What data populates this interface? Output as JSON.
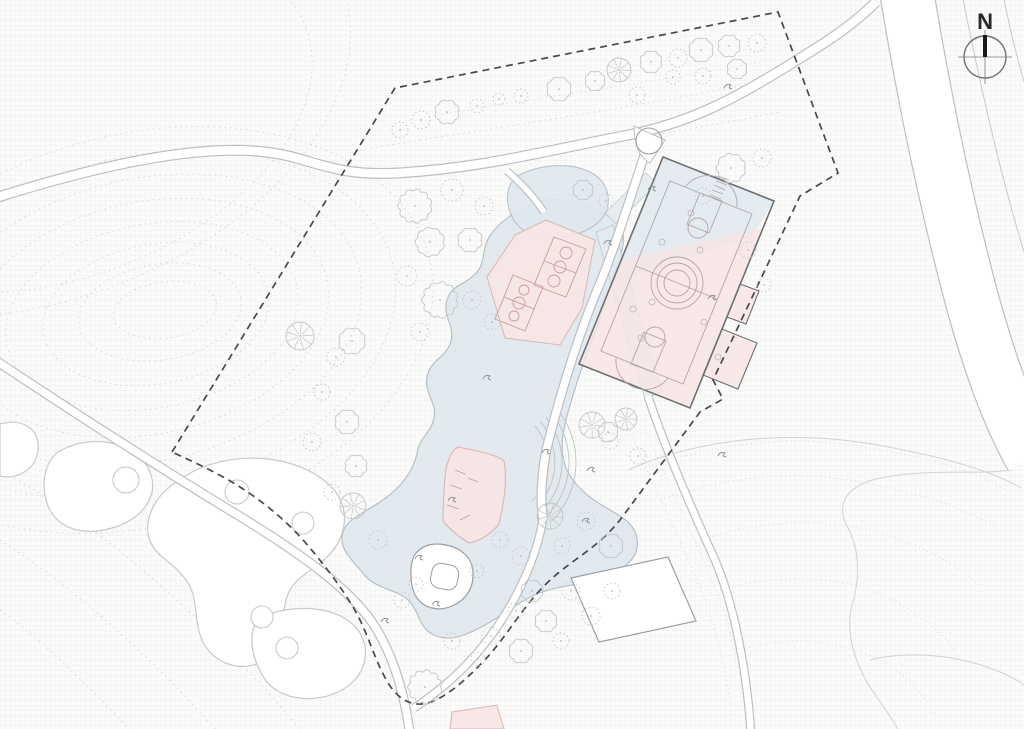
{
  "meta": {
    "title": "Landscape site plan"
  },
  "compass": {
    "label": "N"
  },
  "colors": {
    "contour": "#d4d7d9",
    "stipple": "#d9dcde",
    "meadow": "#cfd3d4",
    "blobEdge": "#c6c9cb",
    "blobFill": "#ffffff",
    "water": "#dfe8ee",
    "waterEdge": "#a9b4bb",
    "street": "#e3ebf0",
    "pink": "#f7e5e4",
    "pinkEdge": "#dcb5b3",
    "courtLinePink": "#c79d9d",
    "courtLineHall": "#b2a4a8",
    "roadCasing": "#bcbfc1",
    "roadFill": "#ffffff",
    "roadThin": "#c6c9cb",
    "hallEdge": "#6d7072",
    "hallBlue": "#dfe8ee",
    "bldgEdge": "#9ba0a3",
    "boundary": "#48494b",
    "tree": "#c2c6c8",
    "treeDot": "#b4b8ba",
    "glyph": "#85898c",
    "amphi": "#b9bec1"
  },
  "contours": {
    "ellipses": [
      [
        140,
        330,
        298,
        196,
        -14
      ],
      [
        142,
        325,
        258,
        168,
        -14
      ],
      [
        145,
        320,
        220,
        141,
        -13
      ],
      [
        148,
        318,
        183,
        116,
        -12
      ],
      [
        152,
        316,
        148,
        92,
        -11
      ],
      [
        156,
        314,
        114,
        70,
        -10
      ],
      [
        160,
        312,
        82,
        48,
        -9
      ],
      [
        165,
        310,
        52,
        28,
        -8
      ],
      [
        60,
        118,
        262,
        160,
        -20
      ],
      [
        40,
        98,
        322,
        202,
        -20
      ]
    ],
    "paths": [
      "M0,470 C90,520 190,600 300,729",
      "M0,540 C70,585 150,655 215,729",
      "M0,610 C50,645 100,700 130,729",
      "M360,150 C480,130 620,110 770,80",
      "M380,175 C500,158 640,140 780,112"
    ]
  },
  "stipple_paths": [
    "M640,470 C720,440 800,435 870,448 C930,458 975,470 1015,495",
    "M660,500 C730,475 800,470 860,482 C915,492 960,505 1000,530",
    "M700,540 C760,520 820,518 870,530 C910,540 950,560 980,585",
    "M720,590 C770,575 830,575 870,590 C905,603 935,625 955,650",
    "M740,650 C790,635 840,640 880,660 C905,673 925,695 935,715",
    "M630,430 C655,490 685,550 705,600 C718,635 728,680 732,715",
    "M643,425 C668,485 698,545 718,595 C731,630 741,676 745,712",
    "M420,118 C520,100 640,85 760,62"
  ],
  "meadow_lines": [
    "M628,470 C700,438 790,430 872,444 C935,455 985,468 1022,488",
    "M1012,470 C980,475 930,468 880,478 C845,486 835,505 848,528 C860,550 860,580 852,605 C846,628 852,660 872,690 C884,708 895,722 900,734",
    "M870,660 C910,650 960,655 1000,672 C1020,680 1032,690 1038,700"
  ],
  "context_blobs": {
    "paths": [
      "M0,424 C22,418 40,428 38,450 C36,470 16,480 0,476 Z",
      "M58,452 C92,432 138,442 150,472 C160,498 140,520 112,528 C85,536 58,530 48,506 C40,484 45,462 58,452 Z",
      "M196,470 C240,450 295,456 326,482 C352,504 348,534 330,554 C316,570 297,574 288,594 C280,614 286,640 270,656 C250,674 218,668 204,644 C192,622 200,598 186,580 C172,560 152,556 148,534 C145,512 160,492 178,481 C184,477 190,473 196,470 Z",
      "M258,618 C295,602 340,606 358,630 C372,650 366,676 342,690 C315,705 278,700 264,678 C252,658 247,636 258,618 Z"
    ],
    "circles": [
      [
        126,
        480,
        13
      ],
      [
        237,
        492,
        12
      ],
      [
        303,
        523,
        11
      ],
      [
        262,
        617,
        11
      ],
      [
        287,
        648,
        11
      ]
    ]
  },
  "water": {
    "pond": "M543,200 C523,207 503,218 492,233 C480,248 487,260 477,272 C466,285 452,284 447,300 C442,316 455,325 451,341 C447,357 430,360 427,377 C424,394 437,401 434,418 C431,434 418,438 417,454 C412,475 398,490 380,502 C360,515 345,520 342,535 C340,550 352,560 362,572 C375,590 395,588 408,600 C420,612 418,626 432,634 C450,644 468,634 485,625 C505,614 520,600 542,592 C565,584 585,585 605,577 C628,568 640,555 637,538 C634,521 616,514 600,504 C585,495 572,482 566,468 C560,452 562,436 566,420 C572,396 584,360 596,330 C606,300 616,270 622,250 C626,235 622,222 608,215 C590,206 565,197 543,200 Z",
    "plaza": "M517,176 C540,164 570,162 590,172 C606,180 612,196 606,212 C598,228 578,236 556,238 C534,240 516,230 510,212 C505,198 507,185 517,176 Z",
    "streets": [
      "596,232 613,225 662,392 645,399",
      "605,213 646,173 657,184 616,224"
    ]
  },
  "amphitheater": {
    "cx": 492,
    "cy": 462,
    "radii": [
      56,
      63,
      70,
      77,
      84
    ],
    "a1": -40,
    "a2": 45
  },
  "pink": {
    "pentagon": "546,220 595,240 582,308 560,345 505,338 487,277 515,235",
    "courts": [
      {
        "poly": "554,237 586,249 566,297 534,285",
        "line": [
          544,
          261,
          576,
          273
        ],
        "circles": [
          [
            560,
            267,
            6
          ],
          [
            566,
            253,
            6
          ],
          [
            554,
            281,
            6
          ]
        ]
      },
      {
        "poly": "513,275 543,287 525,331 495,319",
        "line": [
          504,
          297,
          534,
          309
        ],
        "circles": [
          [
            519,
            303,
            6
          ],
          [
            524,
            290,
            5
          ],
          [
            514,
            316,
            5
          ]
        ]
      }
    ],
    "pavilion": "M458,447 C478,451 498,455 504,461 C508,482 503,506 499,524 C490,535 480,541 469,543 C458,536 449,529 443,521 C443,503 444,486 446,468 C449,458 452,450 458,447 Z",
    "pavilion_marks": [
      [
        455,
        470,
        465,
        474
      ],
      [
        450,
        485,
        462,
        489
      ],
      [
        447,
        505,
        459,
        509
      ],
      [
        460,
        520,
        470,
        515
      ],
      [
        468,
        478,
        478,
        482
      ]
    ],
    "south_fragment": "452,712 497,705 504,729 450,729"
  },
  "roads": [
    {
      "d": "M-5,198 C90,168 185,146 255,151 C312,155 325,177 398,173 C482,168 545,151 628,135 C695,122 745,93 802,57 C833,38 856,22 876,2",
      "w": 11
    },
    {
      "d": "M-5,360 C70,410 160,468 236,514 C302,554 348,588 372,622 C392,652 404,690 410,734",
      "w": 10
    },
    {
      "d": "M650,138 C636,180 619,236 601,281 C581,327 561,391 547,447 C542,472 540,498 543,519",
      "w": 10
    },
    {
      "d": "M543,519 C535,566 510,614 478,652 C455,679 432,696 414,708",
      "w": 9
    },
    {
      "d": "M648,396 C662,440 690,505 715,560 C733,602 747,668 751,734",
      "w": 9
    },
    {
      "d": "M907,-6 C922,85 944,195 972,300 C990,365 1008,415 1032,458",
      "w": 55
    },
    {
      "d": "M507,171 C521,183 534,197 544,212",
      "w": 8
    }
  ],
  "road_extra_lines": [
    "M962,-6 C979,80 999,170 1024,252",
    "M1003,-6 C1010,30 1018,62 1026,88"
  ],
  "island": {
    "path": "M634,126 L665,140 L650,163 C640,158 634,145 634,126 Z",
    "tree": [
      649,
      141,
      13
    ]
  },
  "buildings": {
    "rect_sw": "571,578 668,557 696,621 599,642",
    "pavilion_outer": "M414,556 C420,546 432,542 446,545 C462,548 472,558 473,572 C474,588 466,600 452,606 C438,612 424,608 417,598 C410,588 409,567 414,556 Z",
    "pavilion_inner": {
      "x": 431,
      "y": 564,
      "w": 27,
      "h": 25,
      "rx": 9,
      "rot": 12,
      "cx": 444,
      "cy": 577
    }
  },
  "hall": {
    "outline": "663,157 774,201 690,408 579,364",
    "blue": "663,157 774,201 752,237 612,283",
    "pinkpart": "621,260 763,228 690,408 579,364",
    "bumps": [
      "722,329 757,343 738,389 703,375",
      "740,284 759,291 746,324 727,317"
    ],
    "court": {
      "poly": "670,181 752,214 683,384 601,351",
      "keys": [
        "700,193 722,201 709,233 687,224",
        "631,364 653,372 666,341 644,332"
      ],
      "lines": [
        [
          636,
          266,
          717,
          299
        ]
      ],
      "circles": [
        [
          677,
          283,
          13
        ],
        [
          677,
          283,
          20
        ],
        [
          677,
          283,
          26
        ],
        [
          698,
          228,
          10
        ],
        [
          655,
          337,
          10
        ]
      ],
      "arcs": [
        "M685,187 A29,29 0 0 1 737,207",
        "M616,358 A29,29 0 0 0 668,378"
      ],
      "scatter": [
        [
          700,
          250
        ],
        [
          652,
          302
        ],
        [
          718,
          357
        ],
        [
          641,
          338
        ],
        [
          691,
          213
        ],
        [
          662,
          242
        ],
        [
          704,
          322
        ],
        [
          633,
          309
        ]
      ],
      "ladder": [
        [
          718,
          176,
          729,
          180
        ],
        [
          716,
          181,
          727,
          185
        ],
        [
          714,
          185,
          725,
          190
        ],
        [
          712,
          190,
          723,
          194
        ],
        [
          710,
          195,
          721,
          199
        ]
      ]
    }
  },
  "boundary": "M172,452 L395,88 L778,12 L838,173 L800,196 L713,380 L723,399 L700,412 L620,520 C596,550 570,560 545,585 C520,610 505,640 480,665 C462,683 445,698 428,703 C412,707 400,700 390,686 C376,664 372,645 360,620 C348,596 330,572 310,548 C285,518 255,495 225,478 C205,467 185,458 172,452 Z",
  "trees": [
    [
      415,
      206,
      15,
      "s"
    ],
    [
      452,
      190,
      11,
      "d"
    ],
    [
      484,
      206,
      9,
      "d"
    ],
    [
      430,
      242,
      13,
      "s"
    ],
    [
      470,
      240,
      11,
      "s"
    ],
    [
      407,
      276,
      10,
      "d"
    ],
    [
      440,
      300,
      16,
      "s"
    ],
    [
      472,
      300,
      9,
      "d"
    ],
    [
      492,
      322,
      8,
      "d"
    ],
    [
      420,
      332,
      9,
      "d"
    ],
    [
      352,
      341,
      12,
      "s"
    ],
    [
      300,
      336,
      14,
      "p"
    ],
    [
      336,
      357,
      9,
      "d"
    ],
    [
      322,
      392,
      8,
      "d"
    ],
    [
      347,
      422,
      11,
      "s"
    ],
    [
      312,
      442,
      9,
      "d"
    ],
    [
      356,
      466,
      10,
      "s"
    ],
    [
      332,
      492,
      8,
      "d"
    ],
    [
      353,
      506,
      13,
      "p"
    ],
    [
      378,
      540,
      9,
      "d"
    ],
    [
      400,
      130,
      8,
      "d"
    ],
    [
      421,
      120,
      9,
      "d"
    ],
    [
      447,
      112,
      11,
      "s"
    ],
    [
      477,
      106,
      7,
      "d"
    ],
    [
      499,
      99,
      6,
      "d"
    ],
    [
      521,
      96,
      7,
      "d"
    ],
    [
      559,
      89,
      11,
      "s"
    ],
    [
      595,
      81,
      9,
      "s"
    ],
    [
      619,
      70,
      12,
      "p"
    ],
    [
      651,
      62,
      10,
      "s"
    ],
    [
      678,
      58,
      9,
      "d"
    ],
    [
      701,
      50,
      11,
      "s"
    ],
    [
      729,
      46,
      10,
      "s"
    ],
    [
      757,
      43,
      9,
      "d"
    ],
    [
      637,
      95,
      8,
      "d"
    ],
    [
      673,
      77,
      7,
      "d"
    ],
    [
      703,
      76,
      8,
      "d"
    ],
    [
      737,
      69,
      9,
      "s"
    ],
    [
      583,
      190,
      9,
      "s"
    ],
    [
      606,
      201,
      7,
      "d"
    ],
    [
      731,
      168,
      13,
      "s"
    ],
    [
      762,
      158,
      9,
      "d"
    ],
    [
      703,
      196,
      8,
      "d"
    ],
    [
      748,
      250,
      8,
      "d"
    ],
    [
      764,
      285,
      7,
      "d"
    ],
    [
      626,
      419,
      11,
      "p"
    ],
    [
      610,
      441,
      8,
      "d"
    ],
    [
      608,
      432,
      9,
      "s"
    ],
    [
      638,
      456,
      8,
      "d"
    ],
    [
      592,
      425,
      13,
      "p"
    ],
    [
      550,
      516,
      13,
      "p"
    ],
    [
      500,
      540,
      8,
      "d"
    ],
    [
      521,
      556,
      9,
      "d"
    ],
    [
      477,
      571,
      7,
      "d"
    ],
    [
      532,
      591,
      10,
      "s"
    ],
    [
      562,
      546,
      8,
      "d"
    ],
    [
      586,
      521,
      9,
      "d"
    ],
    [
      611,
      546,
      11,
      "s"
    ],
    [
      571,
      591,
      9,
      "d"
    ],
    [
      546,
      621,
      10,
      "s"
    ],
    [
      516,
      611,
      8,
      "d"
    ],
    [
      491,
      636,
      9,
      "d"
    ],
    [
      521,
      651,
      11,
      "s"
    ],
    [
      561,
      641,
      8,
      "d"
    ],
    [
      591,
      616,
      9,
      "d"
    ],
    [
      612,
      591,
      8,
      "d"
    ],
    [
      478,
      659,
      7,
      "d"
    ],
    [
      452,
      641,
      8,
      "d"
    ],
    [
      425,
      687,
      15,
      "s"
    ],
    [
      402,
      600,
      8,
      "d"
    ],
    [
      416,
      584,
      7,
      "d"
    ]
  ],
  "glyphs": [
    [
      487,
      378
    ],
    [
      452,
      500
    ],
    [
      546,
      452
    ],
    [
      608,
      243
    ],
    [
      652,
      189
    ],
    [
      712,
      298
    ],
    [
      591,
      470
    ],
    [
      385,
      621
    ],
    [
      419,
      558
    ],
    [
      728,
      87
    ],
    [
      436,
      604
    ],
    [
      586,
      521
    ],
    [
      722,
      455
    ]
  ]
}
